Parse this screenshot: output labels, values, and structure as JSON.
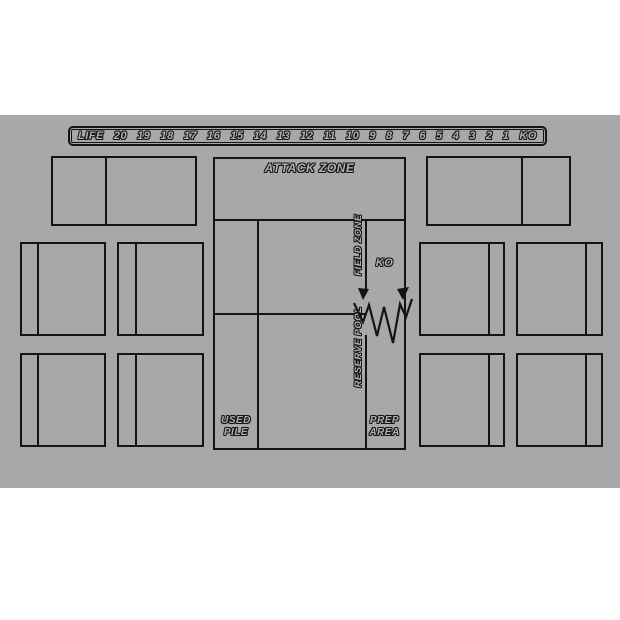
{
  "mat": {
    "background": "#a8a8a8",
    "line_color": "#141414",
    "text_fill": "#b0b0b0"
  },
  "life_bar": {
    "label": "LIFE",
    "values": [
      "20",
      "19",
      "18",
      "17",
      "16",
      "15",
      "14",
      "13",
      "12",
      "11",
      "10",
      "9",
      "8",
      "7",
      "6",
      "5",
      "4",
      "3",
      "2",
      "1",
      "KO"
    ]
  },
  "zones": {
    "attack_zone": {
      "label": "ATTACK ZONE"
    },
    "field_zone": {
      "label": "FIELD ZONE"
    },
    "reserve_pool": {
      "label": "RESERVE POOL"
    },
    "ko": {
      "label": "KO"
    },
    "used_pile": {
      "label": "USED\nPILE"
    },
    "prep_area": {
      "label": "PREP\nAREA"
    }
  }
}
